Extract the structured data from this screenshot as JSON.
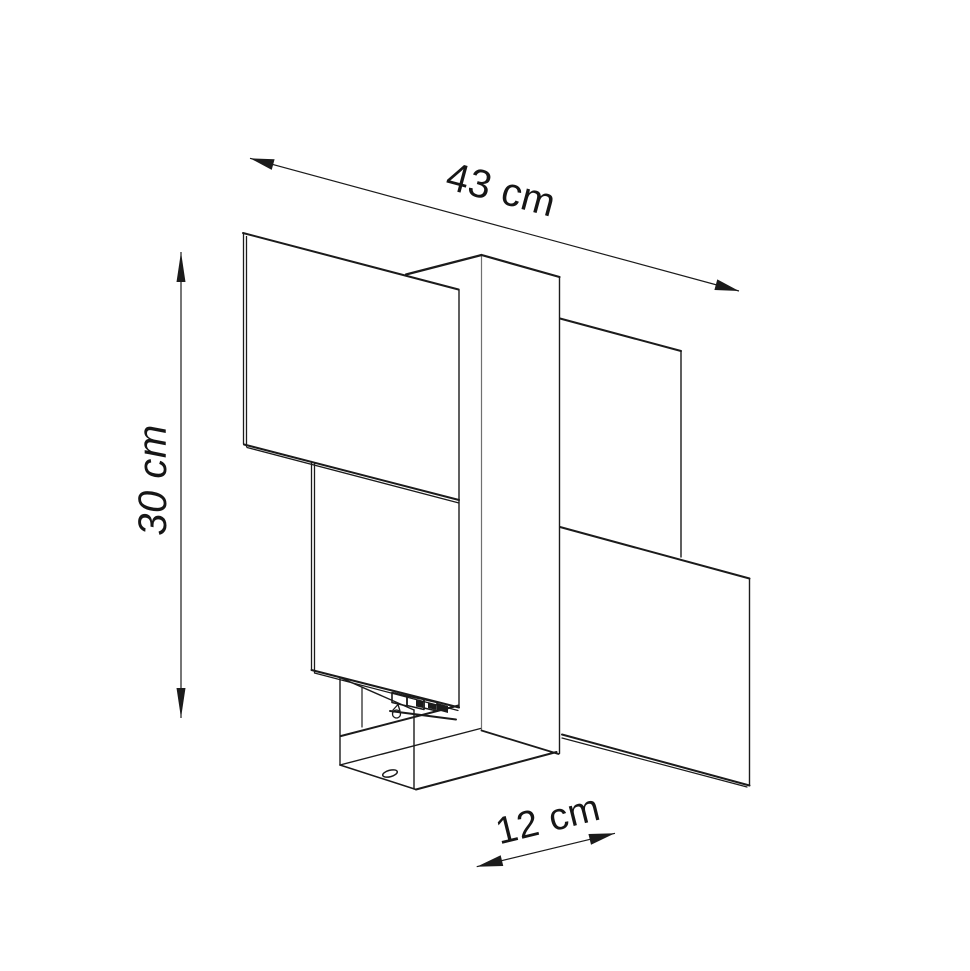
{
  "title": "Wall lamp dimensional line drawing",
  "colors": {
    "background": "#ffffff",
    "line": "#1b1b1b",
    "line_light": "#707070",
    "text": "#161616"
  },
  "dimensions": {
    "width_label": "43 cm",
    "height_label": "30 cm",
    "depth_label": "12 cm"
  },
  "drawing": {
    "labels": [
      {
        "id": "width",
        "text": "43 cm",
        "x": 501,
        "y": 190,
        "rotate": 15,
        "italic": false,
        "size": 40
      },
      {
        "id": "height",
        "text": "30 cm",
        "x": 153,
        "y": 480,
        "rotate": -90,
        "italic": true,
        "size": 40
      },
      {
        "id": "depth",
        "text": "12 cm",
        "x": 548,
        "y": 820,
        "rotate": -14,
        "italic": false,
        "size": 38
      }
    ],
    "dimension_lines": [
      {
        "id": "width",
        "x1": 250,
        "y1": 158.3,
        "x2": 739,
        "y2": 291,
        "ah": 24,
        "aw": 5.5
      },
      {
        "id": "height",
        "x1": 181,
        "y1": 252,
        "x2": 181,
        "y2": 718,
        "ah": 30,
        "aw": 4.5
      },
      {
        "id": "depth",
        "x1": 476.7,
        "y1": 866.7,
        "x2": 615,
        "y2": 833.3,
        "ah": 26,
        "aw": 5.5
      }
    ],
    "lines": [
      {
        "id": "upper-left-panel-top",
        "x1": 243,
        "y1": 233,
        "x2": 458.5,
        "y2": 289.5,
        "w": 2
      },
      {
        "id": "upper-left-panel-left-outer",
        "x1": 243.5,
        "y1": 233,
        "x2": 243.5,
        "y2": 444,
        "w": 1.3
      },
      {
        "id": "upper-left-panel-left-inner",
        "x1": 246.5,
        "y1": 236.5,
        "x2": 246.5,
        "y2": 446.5,
        "w": 1.3
      },
      {
        "id": "upper-left-panel-bottom-outer",
        "x1": 244,
        "y1": 444.5,
        "x2": 459,
        "y2": 500,
        "w": 2
      },
      {
        "id": "upper-left-panel-bottom-inner",
        "x1": 247,
        "y1": 447.5,
        "x2": 459,
        "y2": 503,
        "w": 1.3
      },
      {
        "id": "panel-column-shared-vertical",
        "x1": 459,
        "y1": 289.5,
        "x2": 459,
        "y2": 707.5,
        "w": 1.4
      },
      {
        "id": "column-front-edge",
        "x1": 481.5,
        "y1": 255,
        "x2": 481.5,
        "y2": 730.5,
        "w": 1.2,
        "light": true
      },
      {
        "id": "column-right-edge",
        "x1": 559.5,
        "y1": 277,
        "x2": 559.5,
        "y2": 753.5,
        "w": 1.4
      },
      {
        "id": "column-top-right-edge",
        "x1": 481.5,
        "y1": 255,
        "x2": 559.5,
        "y2": 277,
        "w": 2.2
      },
      {
        "id": "column-top-left-edge",
        "x1": 481.5,
        "y1": 255,
        "x2": 406,
        "y2": 274.5,
        "w": 2.2
      },
      {
        "id": "column-bottom-edge",
        "x1": 481.5,
        "y1": 730.5,
        "x2": 558.5,
        "y2": 754,
        "w": 1.8
      },
      {
        "id": "upper-right-panel-top",
        "x1": 560,
        "y1": 318.5,
        "x2": 681,
        "y2": 351,
        "w": 2
      },
      {
        "id": "upper-right-panel-right",
        "x1": 681,
        "y1": 351,
        "x2": 681,
        "y2": 557,
        "w": 1.4
      },
      {
        "id": "lower-right-panel-top",
        "x1": 560,
        "y1": 527,
        "x2": 749.5,
        "y2": 578.5,
        "w": 2
      },
      {
        "id": "lower-right-panel-right",
        "x1": 749.5,
        "y1": 578.5,
        "x2": 749.5,
        "y2": 785.5,
        "w": 1.4
      },
      {
        "id": "lower-right-panel-bottom-outer",
        "x1": 749.5,
        "y1": 785.5,
        "x2": 562,
        "y2": 734.5,
        "w": 2
      },
      {
        "id": "lower-right-panel-bottom-inner",
        "x1": 747,
        "y1": 787,
        "x2": 562,
        "y2": 738,
        "w": 1.2
      },
      {
        "id": "lower-left-panel-left-outer",
        "x1": 311.5,
        "y1": 461.5,
        "x2": 311.5,
        "y2": 670,
        "w": 1.3
      },
      {
        "id": "lower-left-panel-left-inner",
        "x1": 314.5,
        "y1": 464,
        "x2": 314.5,
        "y2": 672.5,
        "w": 1.3
      },
      {
        "id": "lower-left-panel-bottom-outer",
        "x1": 311.5,
        "y1": 670,
        "x2": 459,
        "y2": 707.5,
        "w": 2
      },
      {
        "id": "lower-left-panel-bottom-inner",
        "x1": 314.5,
        "y1": 673,
        "x2": 458,
        "y2": 710.5,
        "w": 1.2
      },
      {
        "id": "mount-box-back-left-edge",
        "x1": 340,
        "y1": 677.5,
        "x2": 340,
        "y2": 765,
        "w": 1.4
      },
      {
        "id": "mount-box-top-left-edge",
        "x1": 340,
        "y1": 677.5,
        "x2": 414,
        "y2": 710,
        "w": 1.4
      },
      {
        "id": "mount-box-front-left-edge",
        "x1": 414,
        "y1": 710,
        "x2": 414,
        "y2": 789,
        "w": 1.4
      },
      {
        "id": "mount-box-bottom-left-edge",
        "x1": 340,
        "y1": 765,
        "x2": 416,
        "y2": 789.5,
        "w": 1.6
      },
      {
        "id": "mount-box-bottom-front-edge",
        "x1": 416,
        "y1": 789.5,
        "x2": 556.5,
        "y2": 752,
        "w": 2
      },
      {
        "id": "mount-box-bottom-back-edge",
        "x1": 340,
        "y1": 765,
        "x2": 480.5,
        "y2": 728.5,
        "w": 1.4
      },
      {
        "id": "mount-box-inner-vertical",
        "x1": 362,
        "y1": 687,
        "x2": 362,
        "y2": 727,
        "w": 1.2
      },
      {
        "id": "mount-box-inner-bottom-edge",
        "x1": 341,
        "y1": 736,
        "x2": 458.5,
        "y2": 705.5,
        "w": 2
      },
      {
        "id": "terminal-rail",
        "x1": 390,
        "y1": 711,
        "x2": 456,
        "y2": 719.5,
        "w": 2
      },
      {
        "id": "keyhole-tail-left",
        "x1": 393,
        "y1": 710,
        "x2": 398,
        "y2": 704.5,
        "w": 1.3
      },
      {
        "id": "keyhole-tail-right",
        "x1": 398,
        "y1": 704.5,
        "x2": 400,
        "y2": 711,
        "w": 1.3
      }
    ],
    "polygons": [
      {
        "id": "terminal-block-cell-1",
        "points": "392,692.5 407,696 407,706 392,702.5",
        "stroke": true,
        "w": 1.6
      },
      {
        "id": "terminal-block-cell-2",
        "points": "407,696 424,699.5 424,709.5 407,705.5",
        "stroke": true,
        "w": 1.6
      },
      {
        "id": "terminal-block-cell-2-fill",
        "points": "416,700 423,701.5 423,708 416,706.5",
        "fill": "#1b1b1b"
      },
      {
        "id": "terminal-block-cell-3",
        "points": "424,699.5 437,702.5 437,711 424,708",
        "stroke": true,
        "w": 1.6
      },
      {
        "id": "terminal-block-cell-3-fill",
        "points": "428,703 436,705 436,710 428,708",
        "fill": "#1b1b1b"
      },
      {
        "id": "terminal-block-end",
        "points": "437,703 448,706 448,713 437,710",
        "fill": "#1b1b1b"
      }
    ],
    "circles": [
      {
        "id": "keyhole-mounting-hole",
        "cx": 396.5,
        "cy": 714,
        "r": 4,
        "w": 1.3
      }
    ],
    "ellipses": [
      {
        "id": "bottom-screw-hole",
        "cx": 390,
        "cy": 773.5,
        "rx": 7.5,
        "ry": 3.2,
        "rot": -15,
        "w": 1.5
      }
    ]
  }
}
